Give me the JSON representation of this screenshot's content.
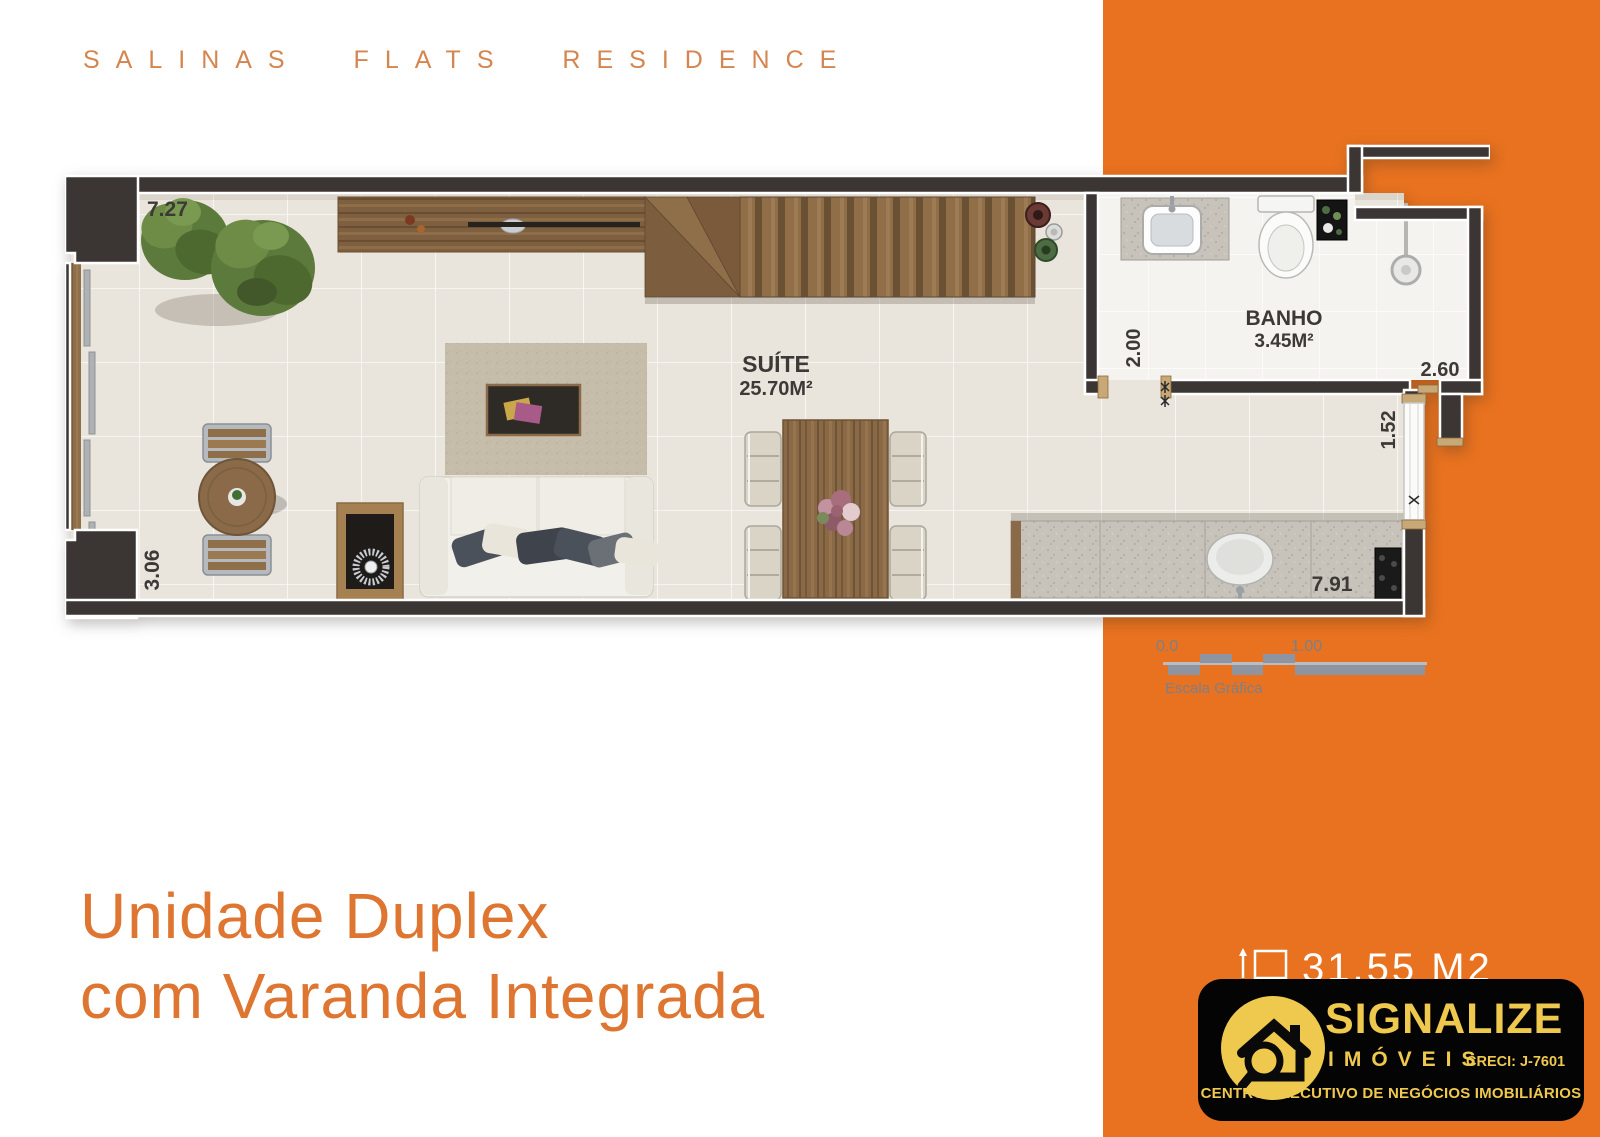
{
  "brand_header": {
    "title": "SALINAS FLATS RESIDENCE"
  },
  "plan": {
    "measurements": {
      "top": "7.27",
      "left": "3.06",
      "bath_left": "2.00",
      "bath_right": "2.60",
      "right": "1.52",
      "kitchen": "7.91"
    },
    "rooms": {
      "suite": {
        "name": "SUÍTE",
        "area": "25.70M²"
      },
      "bath": {
        "name": "BANHO",
        "area": "3.45M²"
      }
    }
  },
  "scale": {
    "zero": "0.0",
    "one": "1.00",
    "caption": "Escala Gráfica"
  },
  "heading": {
    "line1": "Unidade Duplex",
    "line2": "com Varanda Integrada"
  },
  "area_badge": {
    "value": "31.55 M2"
  },
  "logo": {
    "brand": "SIGNALIZE",
    "subtitle": "IMÓVEIS",
    "creci": "CRECI: J-7601",
    "tagline": "CENTRO EXECUTIVO DE NEGÓCIOS IMOBILIÁRIOS"
  },
  "colors": {
    "band_orange": "#E8721F",
    "accent_orange": "#DE7530",
    "muted_orange": "#D5854F",
    "logo_yellow": "#EFC94D",
    "wall_dark": "#3B3634",
    "scale_gray": "#8F95A0"
  }
}
